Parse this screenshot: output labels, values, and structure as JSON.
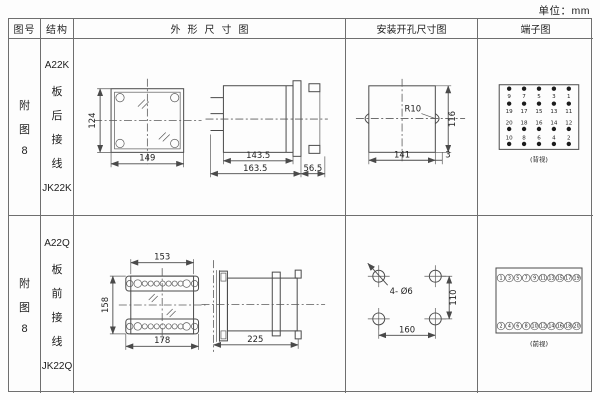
{
  "unit_label": "单位：mm",
  "header": {
    "fig_no": "图号",
    "structure": "结构",
    "outline": "外形尺寸图",
    "mounting": "安装开孔尺寸图",
    "terminal": "端子图"
  },
  "row1": {
    "fig_chars": [
      "附",
      "图",
      "8"
    ],
    "structure_lines": [
      "A22K",
      "板",
      "后",
      "接",
      "线",
      "JK22K"
    ],
    "outline": {
      "front_height": "124",
      "front_width": "149",
      "side_len1": "143.5",
      "side_len2": "163.5",
      "side_len3": "56.5"
    },
    "mounting": {
      "radius": "R10",
      "cut_height": "116",
      "cut_width": "141",
      "offset": "3"
    },
    "terminal": {
      "view_label": "(背视)",
      "row1": [
        "9",
        "7",
        "5",
        "3",
        "1"
      ],
      "row2": [
        "19",
        "17",
        "15",
        "13",
        "11"
      ],
      "row3": [
        "20",
        "18",
        "16",
        "14",
        "12"
      ],
      "row4": [
        "10",
        "8",
        "6",
        "4",
        "2"
      ]
    }
  },
  "row2": {
    "fig_chars": [
      "附",
      "图",
      "8"
    ],
    "structure_lines": [
      "A22Q",
      "板",
      "前",
      "接",
      "线",
      "JK22Q"
    ],
    "outline": {
      "front_top_width": "153",
      "front_height": "158",
      "front_width": "178",
      "side_len": "225"
    },
    "mounting": {
      "holes": "4- Ø6",
      "hole_v_pitch": "110",
      "hole_h_pitch": "160"
    },
    "terminal": {
      "view_label": "(前视)",
      "top": [
        "1",
        "3",
        "5",
        "7",
        "9",
        "11",
        "13",
        "15",
        "17",
        "19"
      ],
      "bottom": [
        "2",
        "4",
        "6",
        "8",
        "10",
        "12",
        "14",
        "16",
        "18",
        "20"
      ]
    }
  }
}
